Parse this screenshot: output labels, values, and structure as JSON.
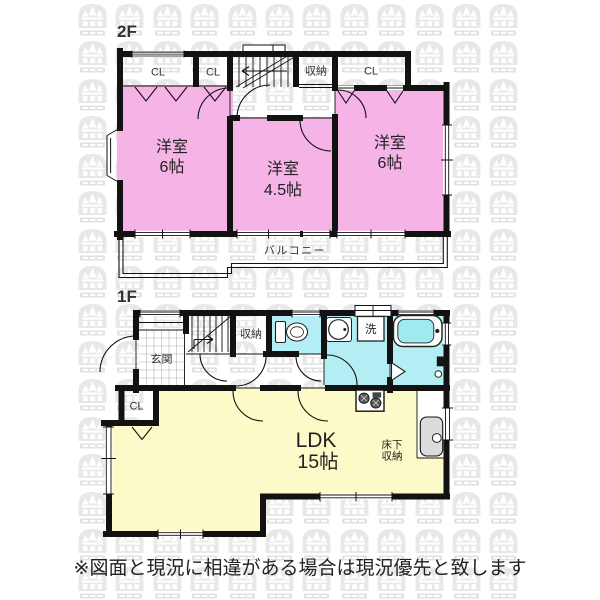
{
  "floor2": {
    "label": "2F",
    "closet1": "CL",
    "closet2": "CL",
    "storage": "収納",
    "closet3": "CL",
    "room_left": {
      "name": "洋室",
      "size": "6帖"
    },
    "room_center": {
      "name": "洋室",
      "size": "4.5帖"
    },
    "room_right": {
      "name": "洋室",
      "size": "6帖"
    },
    "balcony": "バルコニー"
  },
  "floor1": {
    "label": "1F",
    "entrance": "玄関",
    "storage": "収納",
    "laundry": "洗",
    "closet": "CL",
    "ldk": {
      "name": "LDK",
      "size": "15帖"
    },
    "underfloor": {
      "line1": "床下",
      "line2": "収納"
    }
  },
  "footer": {
    "disclaimer": "※図面と現況に相違がある場合は現況優先と致します"
  },
  "colors": {
    "room_pink": "#F5B3E6",
    "room_cyan": "#B4EEF5",
    "room_yellow": "#FCFAC9",
    "bathtub": "#9FE9F1",
    "wall": "#121212",
    "sink_gray": "#DCDCDC",
    "watermark_main": "#E8E8EB",
    "watermark_bar": "#E2E2E6"
  }
}
